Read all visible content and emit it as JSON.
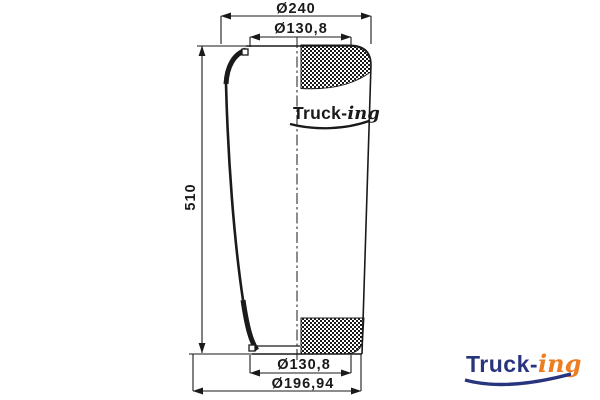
{
  "dimensions": {
    "outer_top": {
      "label": "Ø240"
    },
    "inner_top": {
      "label": "Ø130,8"
    },
    "height": {
      "label": "510"
    },
    "inner_bottom": {
      "label": "Ø130,8"
    },
    "outer_bottom": {
      "label": "Ø196,94"
    }
  },
  "watermark_logo": {
    "text_bold": "Truck-",
    "text_script": "ing"
  },
  "brand_logo": {
    "text_bold": "Truck-",
    "text_script": "ing"
  },
  "colors": {
    "line": "#1a1a1a",
    "brand_navy": "#28357e",
    "brand_orange": "#ee7d22"
  }
}
